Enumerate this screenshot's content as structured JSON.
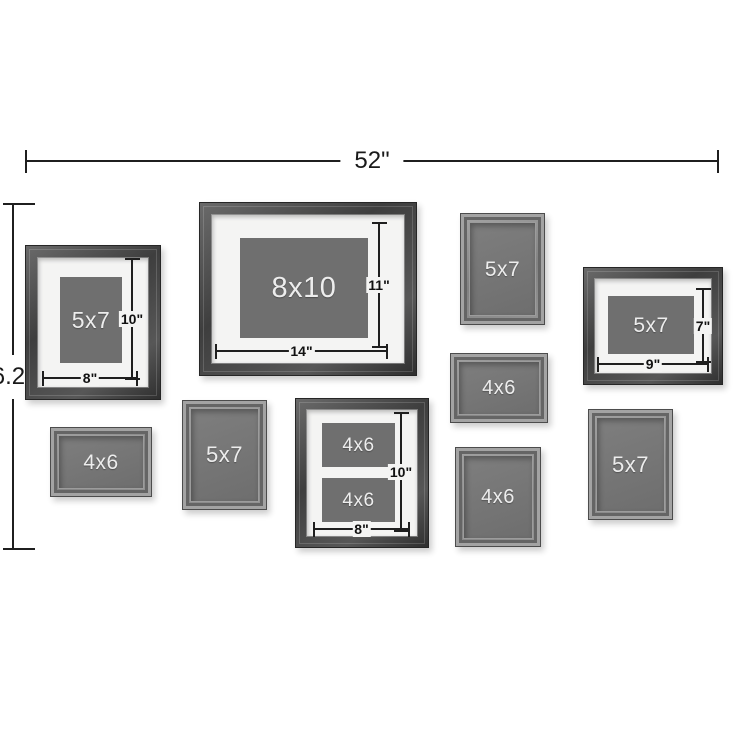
{
  "diagram_title": "gallery wall frame set layout with dimensions",
  "dimensions": {
    "overall_width": "52\"",
    "overall_height": "6.25\""
  },
  "frames": [
    {
      "name": "5x7 matted portrait frame",
      "label": "5x7",
      "height_label": "10\"",
      "width_label": "8\""
    },
    {
      "name": "8x10 matted landscape frame",
      "label": "8x10",
      "height_label": "11\"",
      "width_label": "14\""
    },
    {
      "name": "5x7 plain portrait frame",
      "label": "5x7"
    },
    {
      "name": "5x7 matted landscape frame",
      "label": "5x7",
      "height_label": "7\"",
      "width_label": "9\""
    },
    {
      "name": "4x6 plain landscape frame",
      "label": "4x6"
    },
    {
      "name": "4x6 plain landscape frame",
      "label": "4x6"
    },
    {
      "name": "5x7 plain portrait frame",
      "label": "5x7"
    },
    {
      "name": "collage matted frame",
      "labels": [
        "4x6",
        "4x6"
      ],
      "height_label": "10\"",
      "width_label": "8\""
    },
    {
      "name": "4x6 plain portrait frame",
      "label": "4x6"
    },
    {
      "name": "5x7 plain portrait frame",
      "label": "5x7"
    }
  ],
  "colors": {
    "background": "#ffffff",
    "wood_frame": "#474747",
    "gray_frame": "#8a8a8a",
    "mat": "#f4f4f3",
    "photo_placeholder": "#6f6f6f",
    "dimension_line": "#1f1f1f",
    "label_text": "#ededed"
  }
}
